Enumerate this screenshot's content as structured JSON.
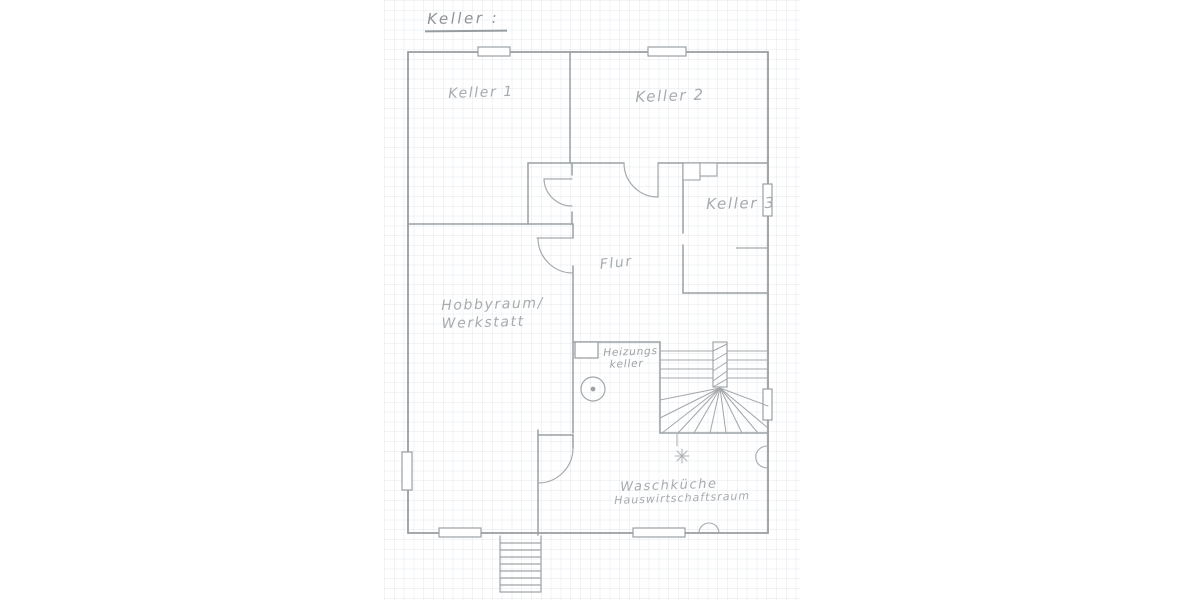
{
  "title": {
    "text": "Keller :"
  },
  "rooms": {
    "keller1": {
      "label": "Keller 1"
    },
    "keller2": {
      "label": "Keller 2"
    },
    "keller3": {
      "label": "Keller 3"
    },
    "flur": {
      "label": "Flur"
    },
    "hobbyraum": {
      "line1": "Hobbyraum/",
      "line2": "Werkstatt"
    },
    "heizungskeller": {
      "line1": "Heizungs",
      "line2": "keller"
    },
    "waschkueche": {
      "line1": "Waschküche",
      "line2": "Hauswirtschaftsraum"
    }
  },
  "symbols": {
    "boiler": "boiler-circle",
    "chimney": "chimney-box",
    "lamp": "light-point-star",
    "interior_stair": "winder-staircase",
    "exterior_stair": "exterior-basement-stairs",
    "windows": "window-markers",
    "doors": "door-swing-arcs"
  },
  "colors": {
    "pencil": "#9aa0a4",
    "pencil_light": "#a9adb0",
    "label_text": "#a7abae",
    "grid": "#dfe3e7",
    "paper": "#ffffff"
  }
}
